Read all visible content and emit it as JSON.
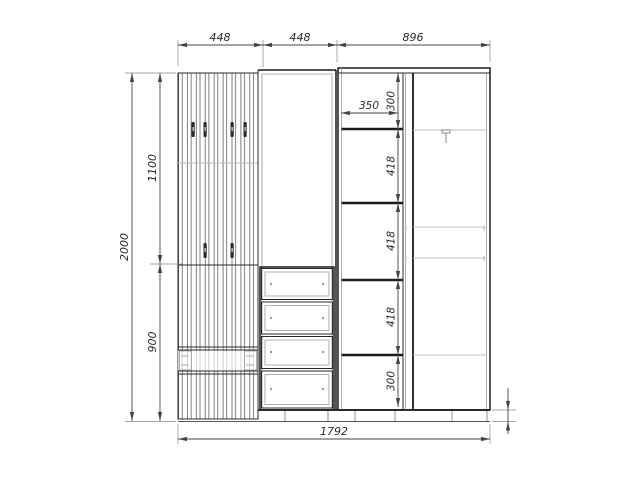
{
  "drawing": {
    "type": "furniture-front-elevation",
    "units": "mm",
    "line_color": "#1c1c1c",
    "dim_color": "#444444",
    "background": "#ffffff"
  },
  "dims": {
    "top_widths": [
      "448",
      "448",
      "896"
    ],
    "height_total": "2000",
    "height_upper": "1100",
    "height_lower": "900",
    "shelf_col_width": "350",
    "shelf_col_heights": [
      "300",
      "418",
      "418",
      "418",
      "300"
    ],
    "plinth_height": "50",
    "width_total": "1792"
  }
}
